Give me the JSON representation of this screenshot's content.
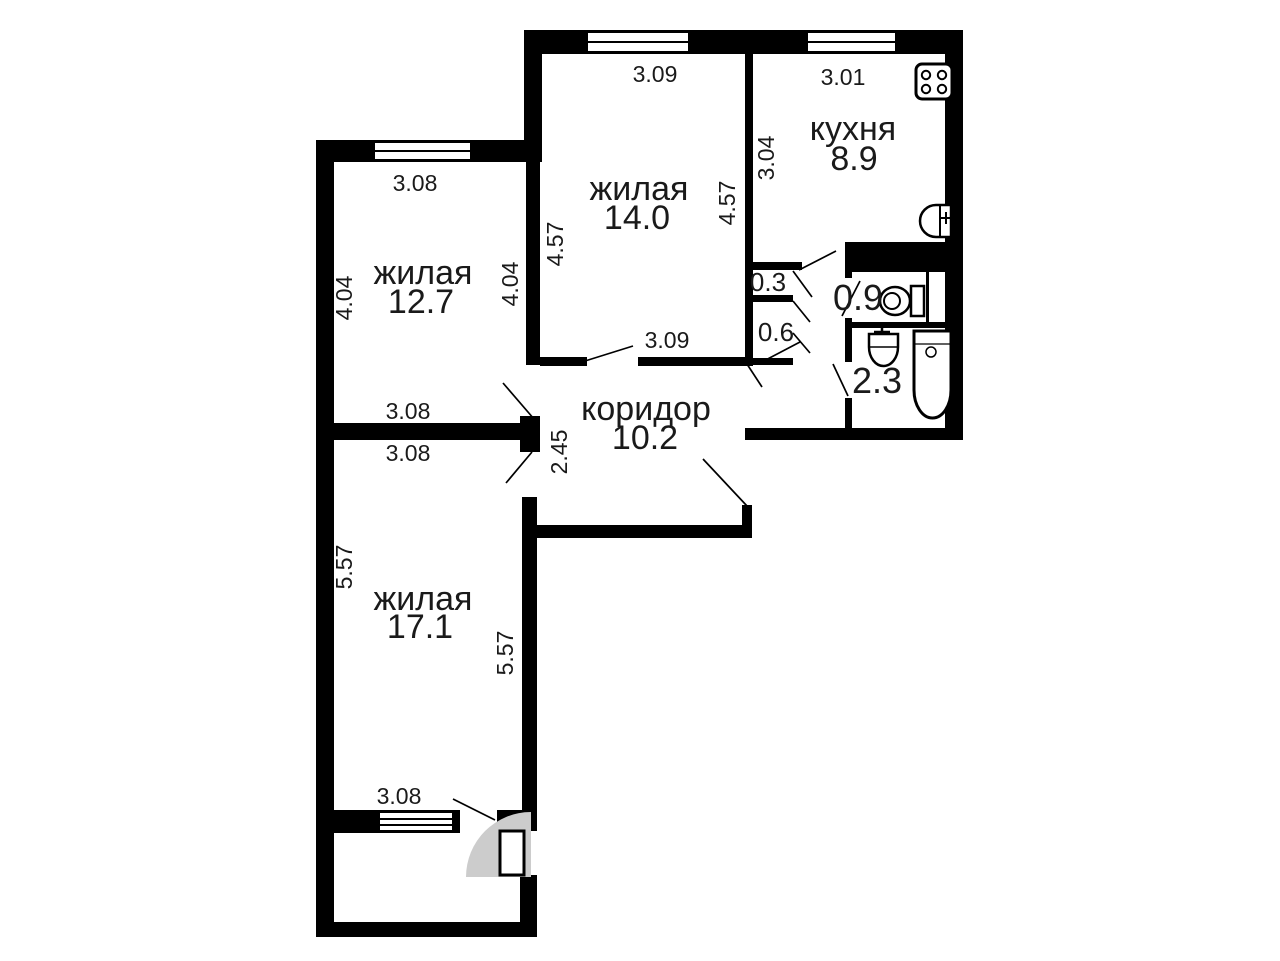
{
  "plan_title": "apartment-floor-plan",
  "colors": {
    "wall": "#000000",
    "background": "#ffffff",
    "text": "#1a1a1a",
    "door_arc": "#cccccc"
  },
  "rooms": {
    "living_top_left": {
      "label": "жилая",
      "area": "12.7"
    },
    "living_top_mid": {
      "label": "жилая",
      "area": "14.0"
    },
    "living_bottom": {
      "label": "жилая",
      "area": "17.1"
    },
    "kitchen": {
      "label": "кухня",
      "area": "8.9"
    },
    "corridor": {
      "label": "коридор",
      "area": "10.2"
    },
    "wc": {
      "area": "0.9"
    },
    "bathroom": {
      "area": "2.3"
    },
    "closet_small": {
      "area": "0.3"
    },
    "closet_large": {
      "area": "0.6"
    }
  },
  "dimensions": {
    "room14_top": "3.09",
    "kitchen_top": "3.01",
    "kitchen_side": "3.04",
    "room14_left": "4.57",
    "room14_right": "4.57",
    "room12_top": "3.08",
    "room12_left": "4.04",
    "room12_right": "4.04",
    "room12_bottom": "3.08",
    "room17_top": "3.08",
    "room14_door": "3.09",
    "corridor_width": "2.45",
    "room17_left": "5.57",
    "room17_right": "5.57",
    "room17_window": "3.08"
  },
  "fixtures": {
    "stove": "stove-icon",
    "kitchen_sink": "kitchen-sink-icon",
    "toilet": "toilet-icon",
    "washbasin": "washbasin-icon",
    "bathtub": "bathtub-icon"
  }
}
